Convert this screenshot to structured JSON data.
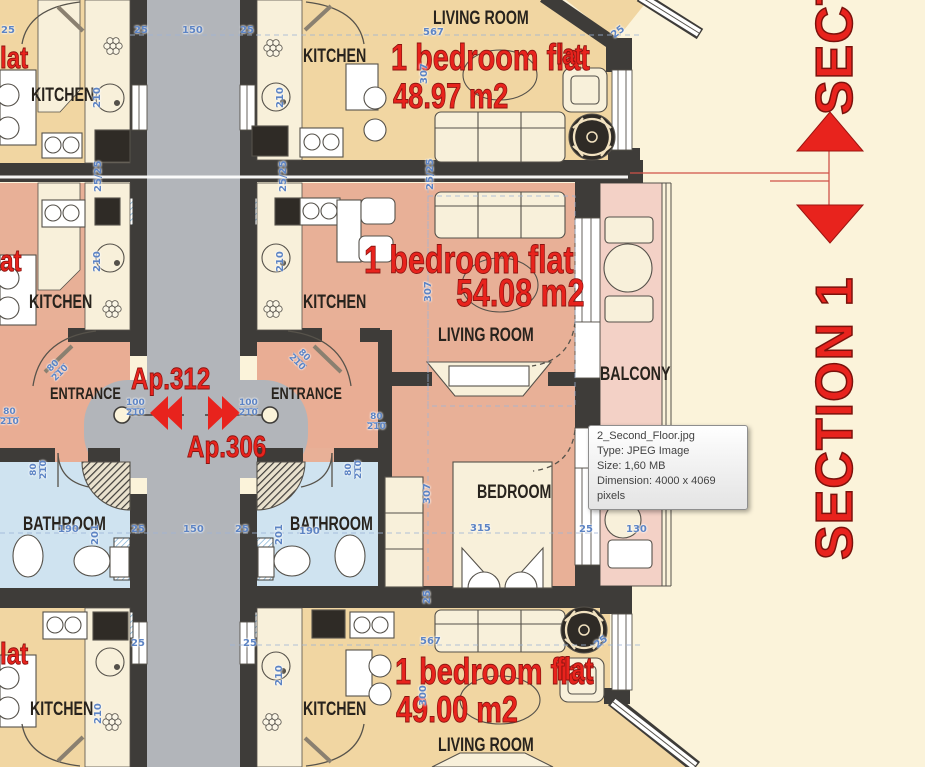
{
  "tooltip": {
    "filename": "2_Second_Floor.jpg",
    "type": "Type: JPEG Image",
    "size": "Size: 1,60 MB",
    "dimension": "Dimension: 4000 x 4069",
    "dimension_cont": "pixels"
  },
  "section_marker": {
    "label": "SECTION 1"
  },
  "apartments": {
    "left": "Ap.312",
    "right": "Ap.306"
  },
  "flats": {
    "top": {
      "name": "1 bedroom flat",
      "area": "48.97 m2",
      "partial_left": "lat",
      "partial_right": "lat"
    },
    "middle": {
      "name": "1 bedroom flat",
      "area": "54.08 m2",
      "partial_left": "at"
    },
    "bottom": {
      "name": "1 bedroom flat",
      "area": "49.00 m2",
      "partial_left": "lat",
      "partial_right": "flat"
    }
  },
  "rooms": {
    "kitchen": "KITCHEN",
    "living_room": "LIVING ROOM",
    "bathroom": "BATHROOM",
    "bedroom": "BEDROOM",
    "balcony": "BALCONY",
    "entrance": "ENTRANCE"
  },
  "dimensions": [
    {
      "t": "25",
      "x": 1,
      "y": 26
    },
    {
      "t": "25",
      "x": 134,
      "y": 26
    },
    {
      "t": "150",
      "x": 182,
      "y": 26
    },
    {
      "t": "25",
      "x": 240,
      "y": 26
    },
    {
      "t": "210",
      "x": 93,
      "y": 108,
      "r": -90
    },
    {
      "t": "210",
      "x": 276,
      "y": 108,
      "r": -90
    },
    {
      "t": "567",
      "x": 423,
      "y": 28
    },
    {
      "t": "25",
      "x": 610,
      "y": 33,
      "r": -38
    },
    {
      "t": "307",
      "x": 420,
      "y": 84,
      "r": -90
    },
    {
      "t": "25/25",
      "x": 94,
      "y": 192,
      "r": -90
    },
    {
      "t": "25/25",
      "x": 279,
      "y": 192,
      "r": -90
    },
    {
      "t": "25/25",
      "x": 426,
      "y": 190,
      "r": -90
    },
    {
      "t": "210",
      "x": 93,
      "y": 272,
      "r": -90
    },
    {
      "t": "210",
      "x": 276,
      "y": 272,
      "r": -90
    },
    {
      "t": "307",
      "x": 424,
      "y": 302,
      "r": -90
    },
    {
      "t": "80/210",
      "x": 44,
      "y": 370,
      "r": -45,
      "f": true
    },
    {
      "t": "80/210",
      "x": 300,
      "y": 346,
      "r": 45,
      "f": true
    },
    {
      "t": "80/210",
      "x": 0,
      "y": 408,
      "f": true
    },
    {
      "t": "80/210",
      "x": 30,
      "y": 479,
      "r": -90,
      "f": true
    },
    {
      "t": "80/210",
      "x": 345,
      "y": 479,
      "r": -90,
      "f": true
    },
    {
      "t": "100/210",
      "x": 126,
      "y": 399,
      "f": true
    },
    {
      "t": "100/210",
      "x": 239,
      "y": 399,
      "f": true
    },
    {
      "t": "80/210",
      "x": 367,
      "y": 413,
      "f": true
    },
    {
      "t": "190",
      "x": 58,
      "y": 525
    },
    {
      "t": "201",
      "x": 91,
      "y": 545,
      "r": -90
    },
    {
      "t": "25",
      "x": 131,
      "y": 525
    },
    {
      "t": "150",
      "x": 183,
      "y": 525
    },
    {
      "t": "25",
      "x": 235,
      "y": 525
    },
    {
      "t": "201",
      "x": 275,
      "y": 545,
      "r": -90
    },
    {
      "t": "190",
      "x": 299,
      "y": 527
    },
    {
      "t": "307",
      "x": 423,
      "y": 504,
      "r": -90
    },
    {
      "t": "315",
      "x": 470,
      "y": 524
    },
    {
      "t": "25",
      "x": 579,
      "y": 525
    },
    {
      "t": "130",
      "x": 626,
      "y": 525
    },
    {
      "t": "25",
      "x": 423,
      "y": 604,
      "r": -90
    },
    {
      "t": "25",
      "x": 243,
      "y": 639
    },
    {
      "t": "567",
      "x": 420,
      "y": 637
    },
    {
      "t": "25",
      "x": 593,
      "y": 643,
      "r": -38
    },
    {
      "t": "210",
      "x": 275,
      "y": 686,
      "r": -90
    },
    {
      "t": "300",
      "x": 419,
      "y": 706,
      "r": -90
    },
    {
      "t": "210",
      "x": 94,
      "y": 724,
      "r": -90
    },
    {
      "t": "25",
      "x": 131,
      "y": 639
    }
  ],
  "colors": {
    "background": "#fbf3da",
    "corridor": "#b2b5ba",
    "wall": "#3e3c39",
    "floor_tan": "#f1d6a2",
    "floor_salmon": "#e8b097",
    "floor_pink": "#f3d1c6",
    "floor_blue": "#cfe3f0",
    "accent_red": "#e8231d",
    "dim_blue": "#5d84c4"
  }
}
